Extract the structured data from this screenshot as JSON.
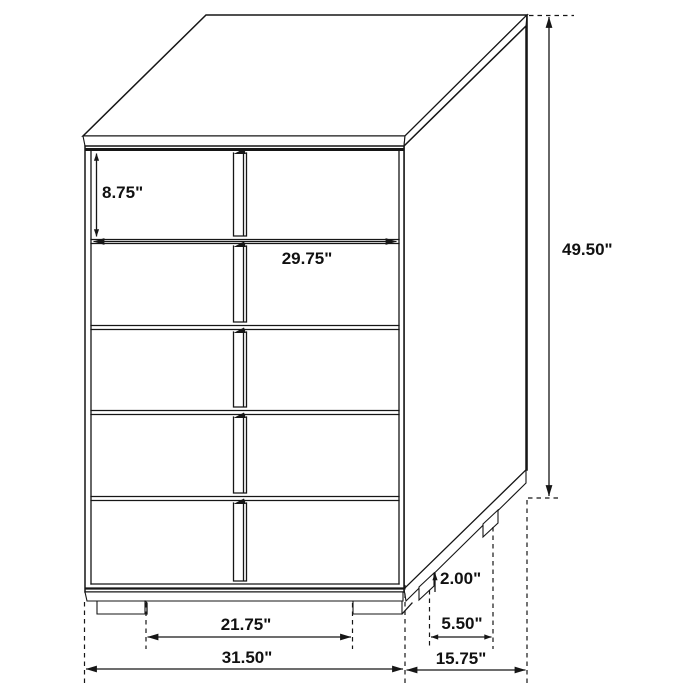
{
  "colors": {
    "line": "#161616",
    "background": "#ffffff",
    "label": "#111111"
  },
  "dimensions": {
    "drawer_face_height": "8.75\"",
    "drawer_width": "29.75\"",
    "overall_height": "49.50\"",
    "leg_height": "2.00\"",
    "side_leg_span": "5.50\"",
    "overall_depth": "15.75\"",
    "front_leg_span": "21.75\"",
    "overall_width": "31.50\""
  }
}
